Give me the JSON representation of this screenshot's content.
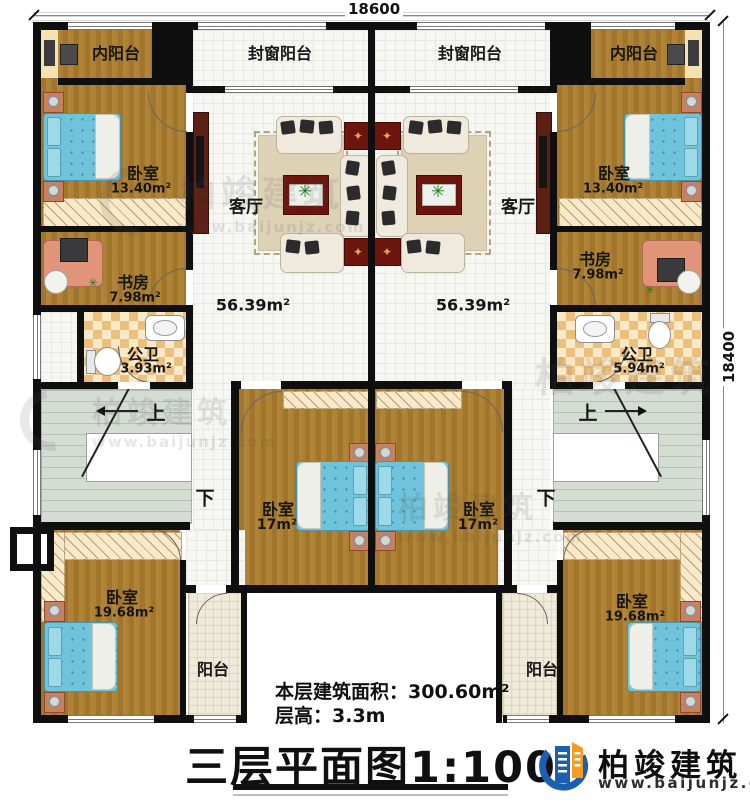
{
  "dimensions": {
    "top": "18600",
    "right": "18400"
  },
  "units": {
    "left": {
      "inner_balcony": "内阳台",
      "window_balcony": "封窗阳台",
      "living": "客厅",
      "living_area": "56.39m²",
      "bedroom_top": "卧室",
      "bedroom_top_area": "13.40m²",
      "study": "书房",
      "study_area": "7.98m²",
      "bath": "公卫",
      "bath_area": "3.93m²",
      "up": "上",
      "down": "下",
      "bedroom_mid": "卧室",
      "bedroom_mid_area": "17m²",
      "bedroom_bottom": "卧室",
      "bedroom_bottom_area": "19.68m²",
      "balcony": "阳台"
    },
    "right": {
      "inner_balcony": "内阳台",
      "window_balcony": "封窗阳台",
      "living": "客厅",
      "living_area": "56.39m²",
      "bedroom_top": "卧室",
      "bedroom_top_area": "13.40m²",
      "study": "书房",
      "study_area": "7.98m²",
      "bath": "公卫",
      "bath_area": "5.94m²",
      "up": "上",
      "down": "下",
      "bedroom_mid": "卧室",
      "bedroom_mid_area": "17m²",
      "bedroom_bottom": "卧室",
      "bedroom_bottom_area": "19.68m²",
      "balcony": "阳台"
    }
  },
  "footer": {
    "area_line": "本层建筑面积：300.60m²",
    "height_line": "层高：3.3m",
    "title": "三层平面图1:100"
  },
  "logo": {
    "name": "柏竣建筑",
    "site": "www.baijunjz.com"
  },
  "watermark": {
    "name": "柏竣建筑",
    "site": "www.baijunjz.com"
  },
  "icons": {
    "star": "✦",
    "plant": "✳"
  }
}
